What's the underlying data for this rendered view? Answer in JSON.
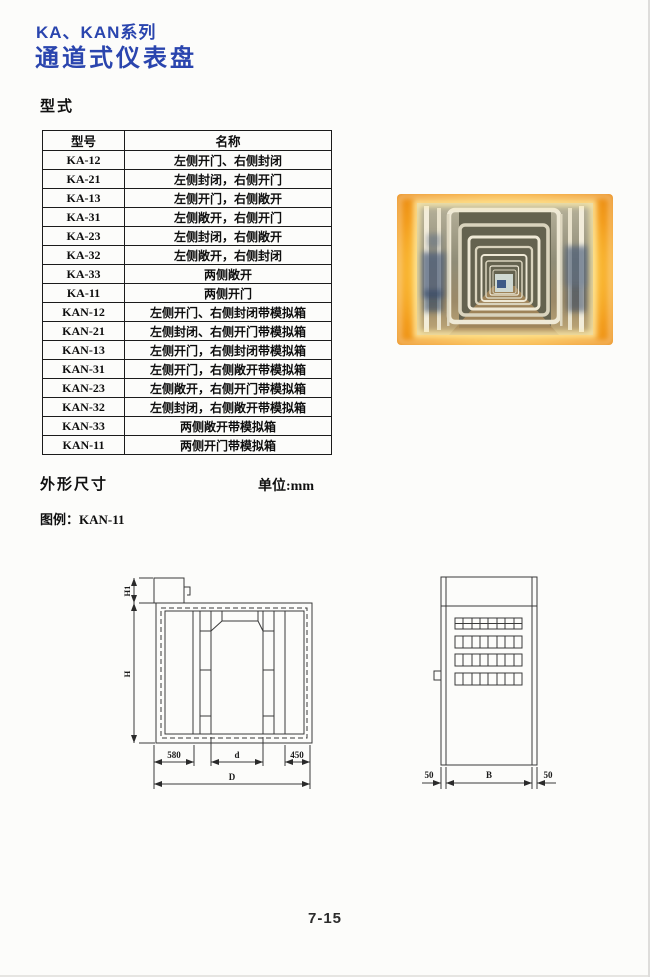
{
  "header": {
    "series": "KA、KAN系列",
    "title": "通道式仪表盘"
  },
  "sections": {
    "type": "型式",
    "dimensions": "外形尺寸",
    "unit": "单位:mm",
    "legend": "图例：KAN-11"
  },
  "table": {
    "headers": [
      "型号",
      "名称"
    ],
    "rows": [
      [
        "KA-12",
        "左侧开门、右侧封闭"
      ],
      [
        "KA-21",
        "左侧封闭，右侧开门"
      ],
      [
        "KA-13",
        "左侧开门，右侧敞开"
      ],
      [
        "KA-31",
        "左侧敞开，右侧开门"
      ],
      [
        "KA-23",
        "左侧封闭，右侧敞开"
      ],
      [
        "KA-32",
        "左侧敞开，右侧封闭"
      ],
      [
        "KA-33",
        "两侧敞开"
      ],
      [
        "KA-11",
        "两侧开门"
      ],
      [
        "KAN-12",
        "左侧开门、右侧封闭带模拟箱"
      ],
      [
        "KAN-21",
        "左侧封闭、右侧开门带模拟箱"
      ],
      [
        "KAN-13",
        "左侧开门，右侧封闭带模拟箱"
      ],
      [
        "KAN-31",
        "左侧开门，右侧敞开带模拟箱"
      ],
      [
        "KAN-23",
        "左侧敞开，右侧开门带模拟箱"
      ],
      [
        "KAN-32",
        "左侧封闭，右侧敞开带模拟箱"
      ],
      [
        "KAN-33",
        "两侧敞开带模拟箱"
      ],
      [
        "KAN-11",
        "两侧开门带模拟箱"
      ]
    ]
  },
  "drawings": {
    "front": {
      "h1": "H1",
      "h": "H",
      "w_left": "580",
      "w_door": "d",
      "w_right": "450",
      "w_total": "D"
    },
    "side": {
      "wall_left": "50",
      "width": "B",
      "wall_right": "50"
    }
  },
  "footer": {
    "page_number": "7-15"
  },
  "colors": {
    "title_blue": "#2a45ae",
    "photo_orange": "#ee9017",
    "photo_yellow": "#ffd95e"
  }
}
